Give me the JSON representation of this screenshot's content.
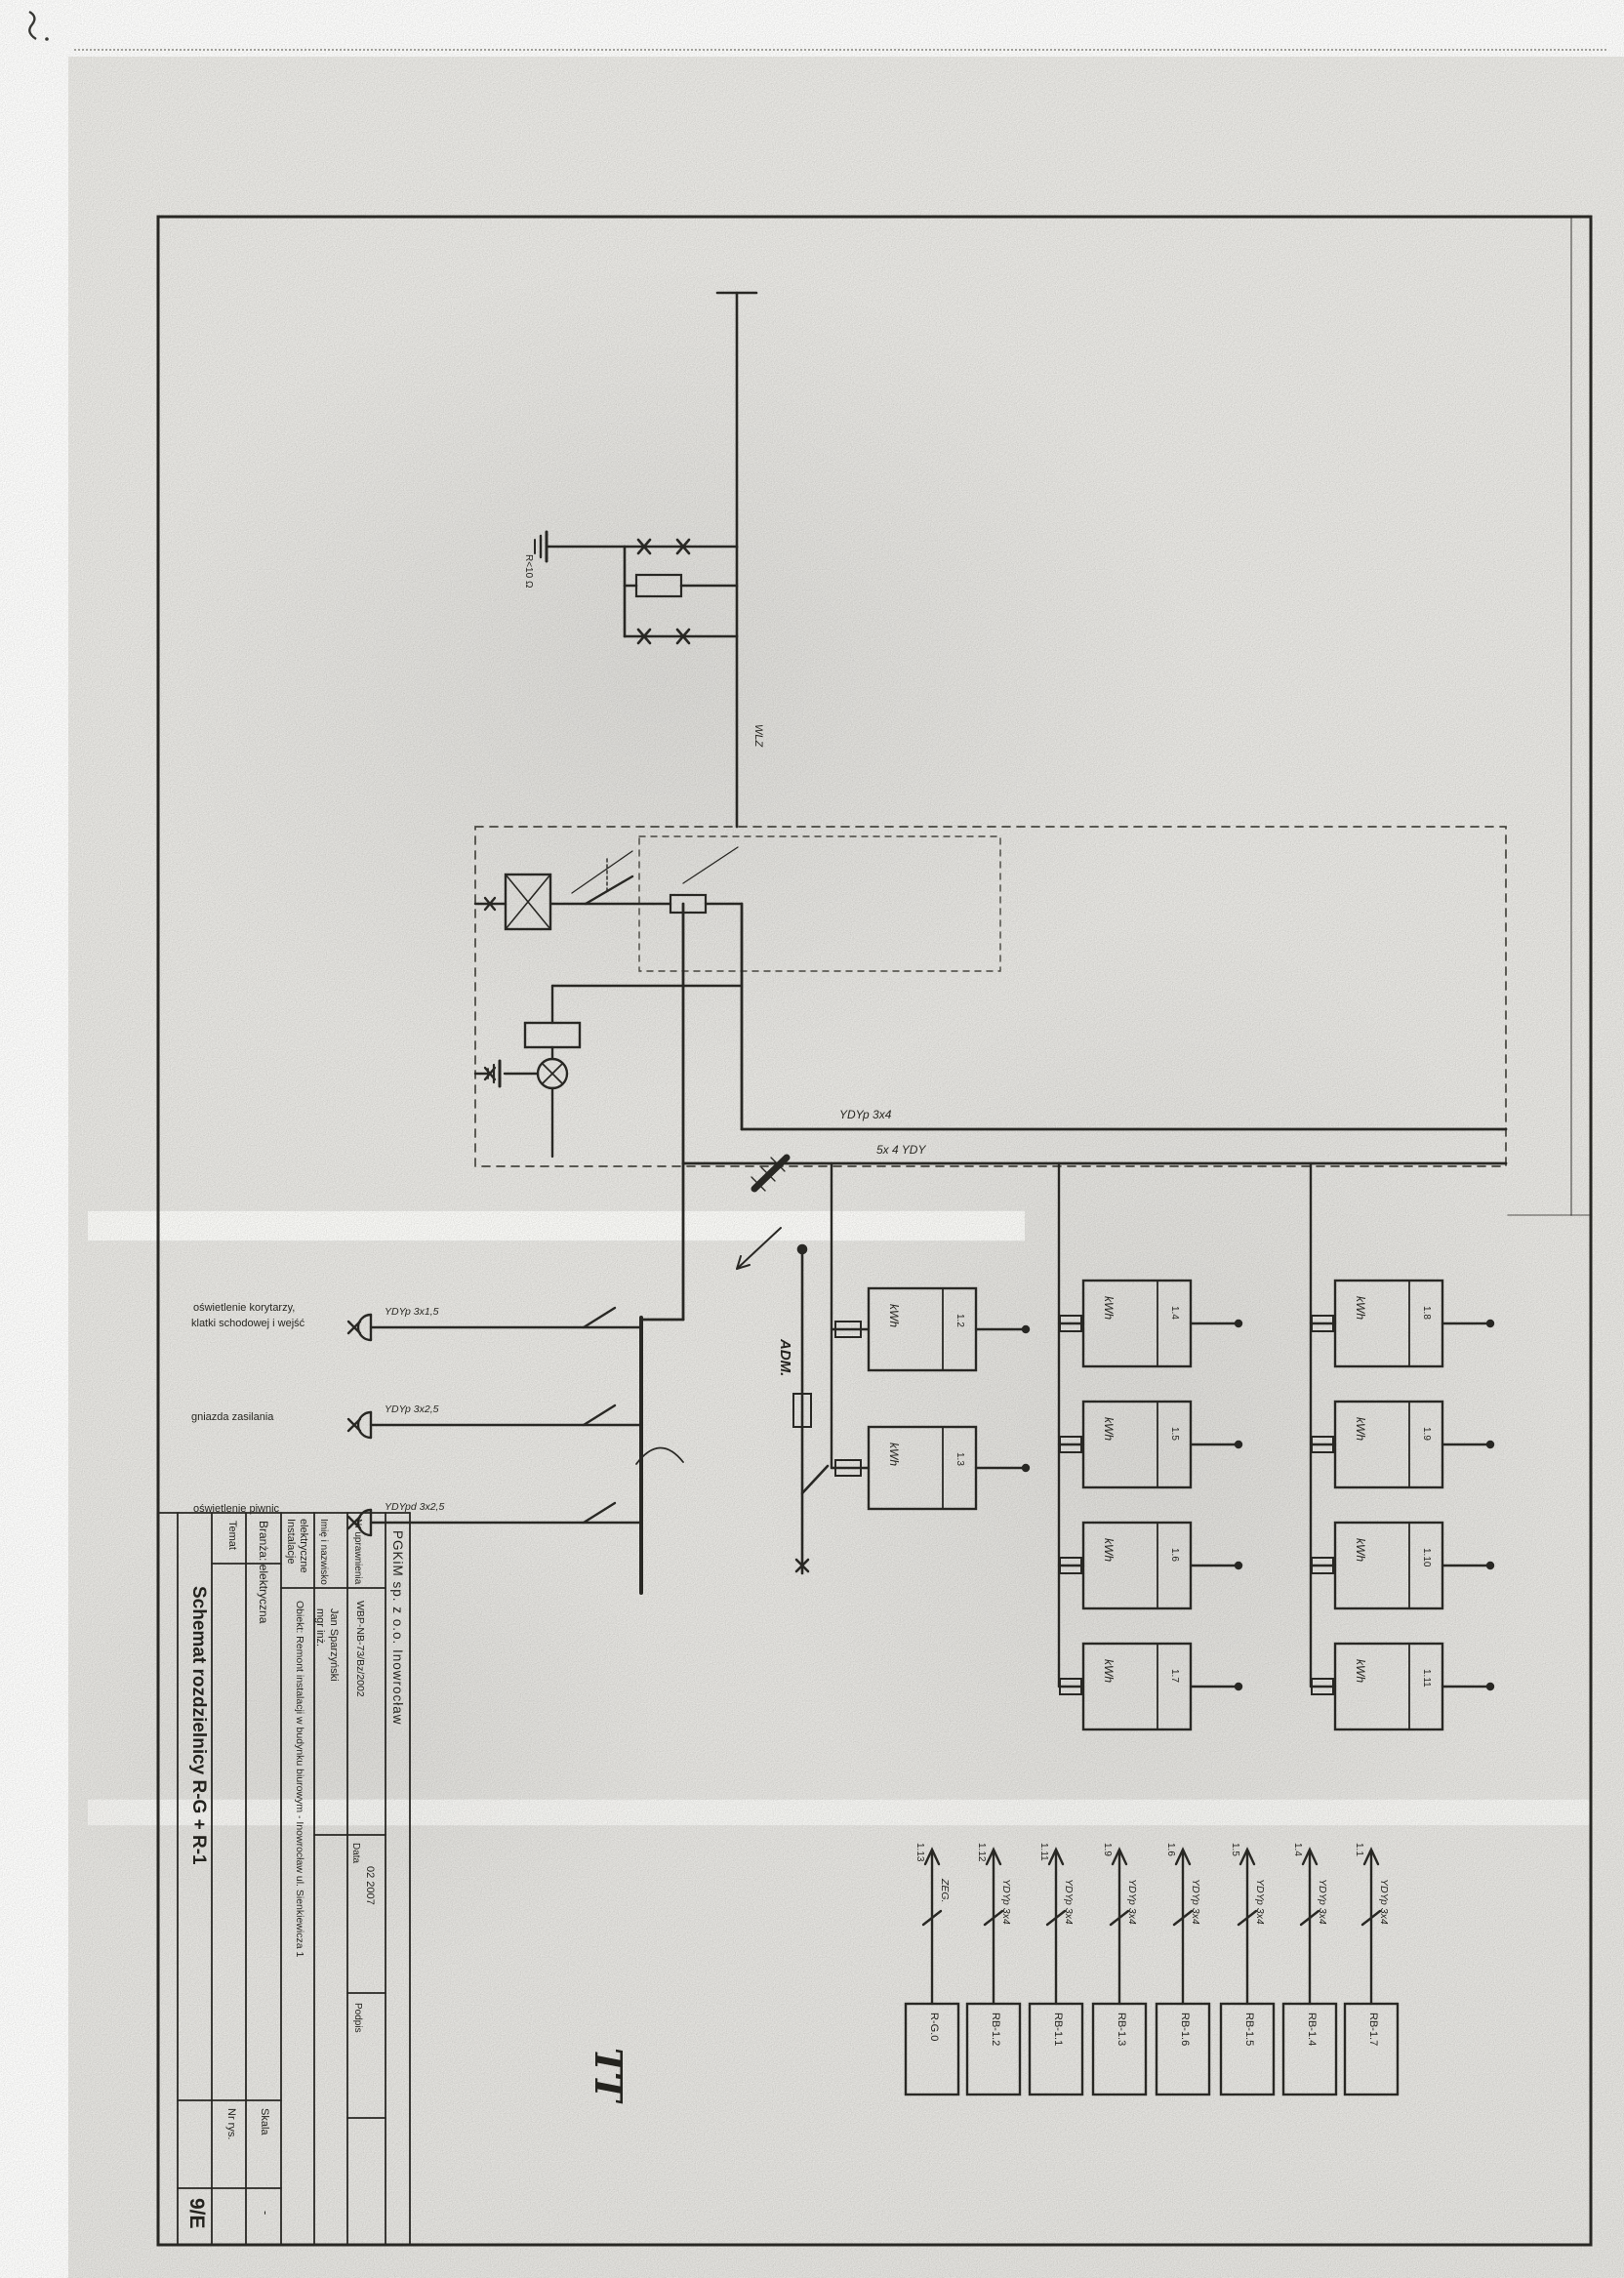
{
  "title_block": {
    "company": "PGKiM sp. z o.o. Inowrocław",
    "temat_label": "Temat",
    "title": "Schemat rozdzielnicy R-G + R-1",
    "branza": "Branża:  elektryczna",
    "instalacje_line1": "Instalacje",
    "instalacje_line2": "elektryczne",
    "obiekt": "Obiekt:  Remont instalacji w budynku biurowym - Inowrocław  ul. Sienkiewicza 1",
    "imie_label": "Imię i nazwisko",
    "imie_value_line1": "mgr inż.",
    "imie_value_line2": "Jan Sparzyński",
    "upr_label": "Nr uprawnienia",
    "upr_value": "WBP-NB-73/Bz/2002",
    "data_label": "Data",
    "data_value": "02 2007",
    "podpis_label": "Podpis",
    "skala_label": "Skala",
    "skala_value": "-",
    "nr_rys_label": "Nr rys.",
    "sheet_no": "9/E"
  },
  "labels": {
    "adm": "ADM.",
    "wlz": "WLZ",
    "ground_resistance": "R<10 Ω",
    "earthing_system": "TT"
  },
  "runs": {
    "run1": "YDYp 3x4",
    "run2": "5x 4 YDY"
  },
  "circuits": {
    "rows": [
      {
        "label_line1": "oświetlenie korytarzy,",
        "label_line2": "klatki schodowej i wejść",
        "cable": "YDYp 3x1,5"
      },
      {
        "label_line1": "gniazda zasilania",
        "label_line2": "",
        "cable": "YDYp 3x2,5"
      },
      {
        "label_line1": "oświetlenie piwnic",
        "label_line2": "",
        "cable": "YDYpd 3x2,5"
      }
    ]
  },
  "meters": {
    "unit": "kWh",
    "cols": [
      {
        "nums": [
          "1.2",
          "1.3"
        ]
      },
      {
        "nums": [
          "1.4",
          "1.5",
          "1.6",
          "1.7"
        ]
      },
      {
        "nums": [
          "1.8",
          "1.9",
          "1.10",
          "1.11"
        ]
      }
    ]
  },
  "feeders": {
    "items": [
      {
        "num": "1.13",
        "cable": "ZEG.",
        "box": "R-G.0"
      },
      {
        "num": "1.12",
        "cable": "YDYp 3x4",
        "box": "RB-1.2"
      },
      {
        "num": "1.11",
        "cable": "YDYp 3x4",
        "box": "RB-1.1"
      },
      {
        "num": "1.9",
        "cable": "YDYp 3x4",
        "box": "RB-1.3"
      },
      {
        "num": "1.6",
        "cable": "YDYp 3x4",
        "box": "RB-1.6"
      },
      {
        "num": "1.5",
        "cable": "YDYp 3x4",
        "box": "RB-1.5"
      },
      {
        "num": "1.4",
        "cable": "YDYp 3x4",
        "box": "RB-1.4"
      },
      {
        "num": "1.1",
        "cable": "YDYp 3x4",
        "box": "RB-1.7"
      }
    ]
  }
}
